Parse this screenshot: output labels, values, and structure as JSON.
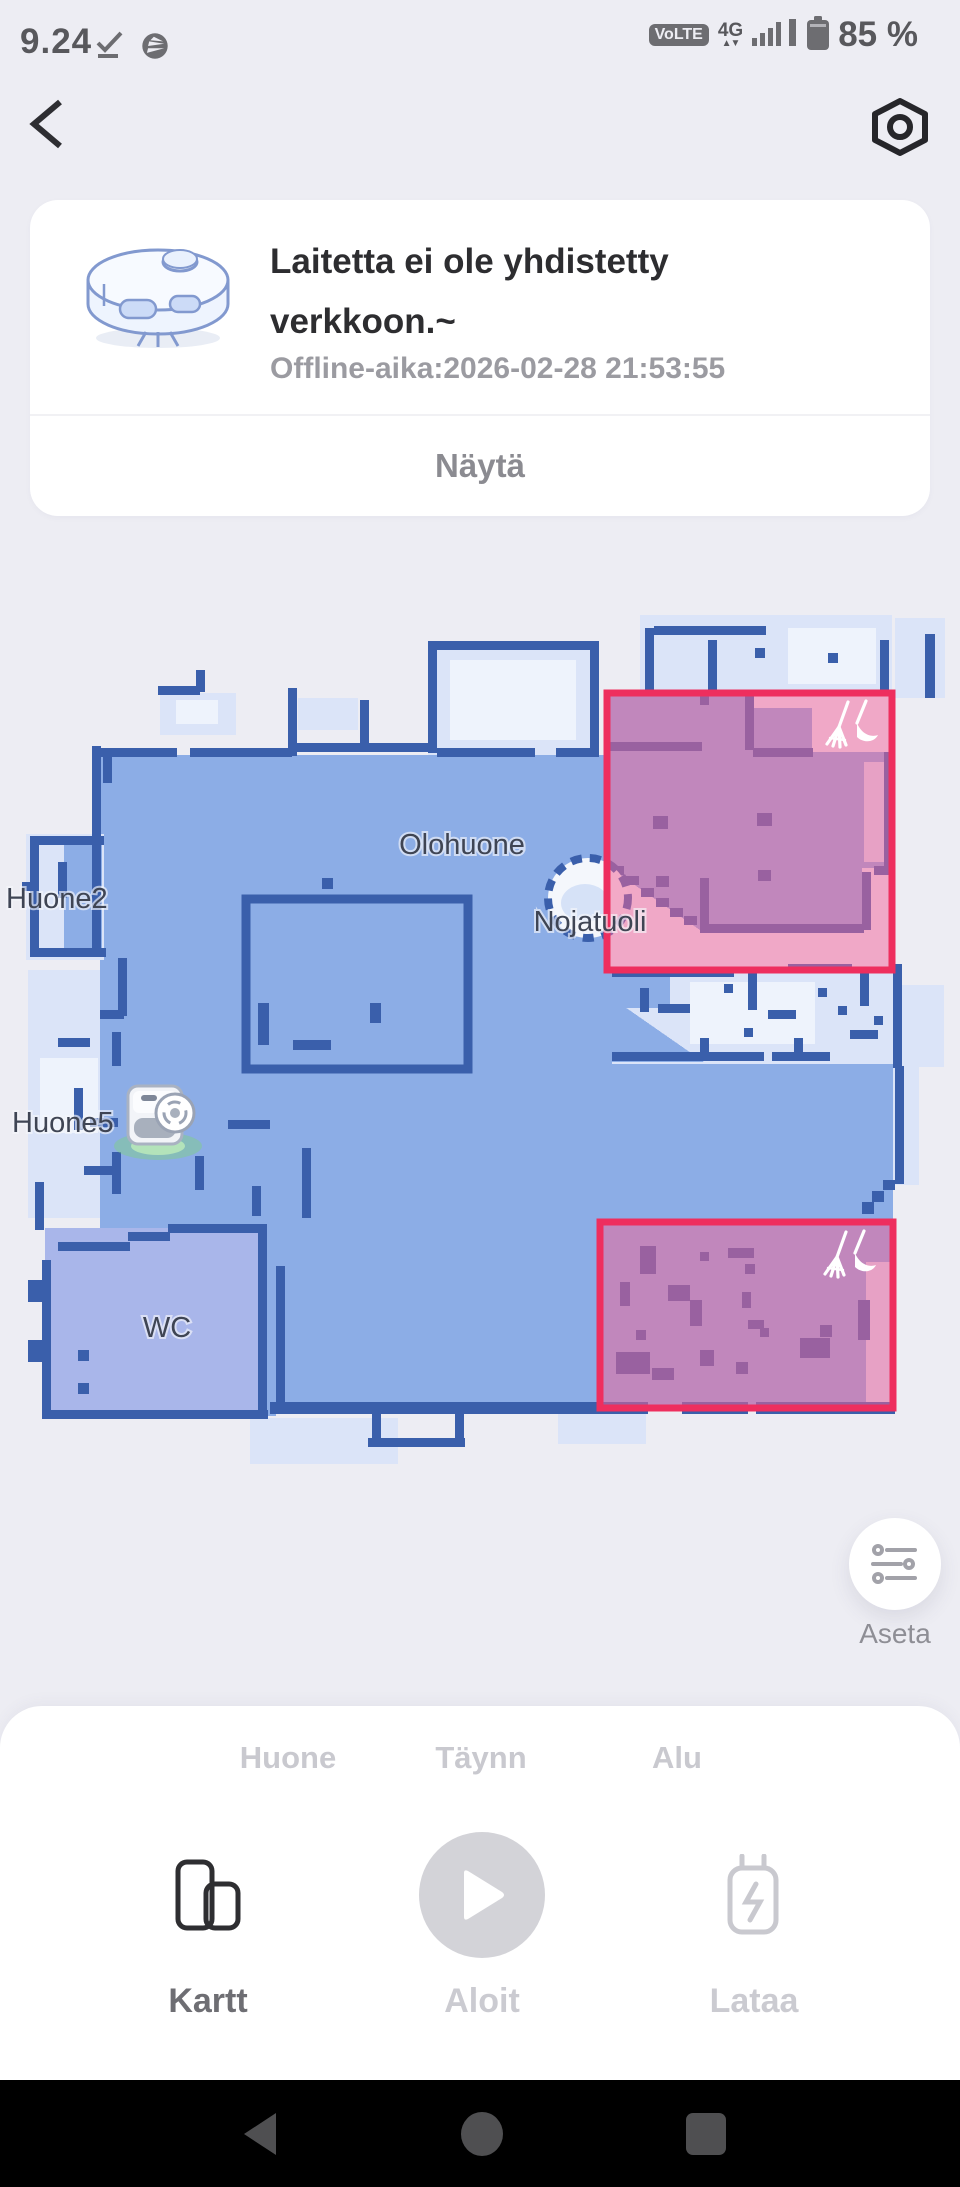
{
  "status_bar": {
    "time": "9.24",
    "volte_badge": "VoLTE",
    "network": "4G",
    "battery_percent": "85 %"
  },
  "device_card": {
    "title_line1": "Laitetta ei ole yhdistetty",
    "title_line2": "verkkoon.~",
    "offline_time": "Offline-aika:2026-02-28 21:53:55",
    "show_button": "Näytä"
  },
  "map": {
    "rooms": {
      "huone2": "Huone2",
      "olohuone": "Olohuone",
      "nojatuoli": "Nojatuoli",
      "huone5": "Huone5",
      "wc": "WC"
    },
    "settings_label": "Aseta",
    "zone_count": 2
  },
  "bottom_sheet": {
    "tabs": [
      {
        "label": "Huone"
      },
      {
        "label": "Täynn"
      },
      {
        "label": "Alu"
      }
    ],
    "actions": [
      {
        "label": "Kartt"
      },
      {
        "label": "Aloit"
      },
      {
        "label": "Lataa"
      }
    ]
  },
  "colors": {
    "accent_red": "#ee2e5e",
    "zone_fill": "rgba(242,100,150,0.52)",
    "floor_blue": "#8cade6",
    "wall_blue": "#3a5fab",
    "robot_glow": "#7fd183",
    "background": "#ededf3"
  }
}
